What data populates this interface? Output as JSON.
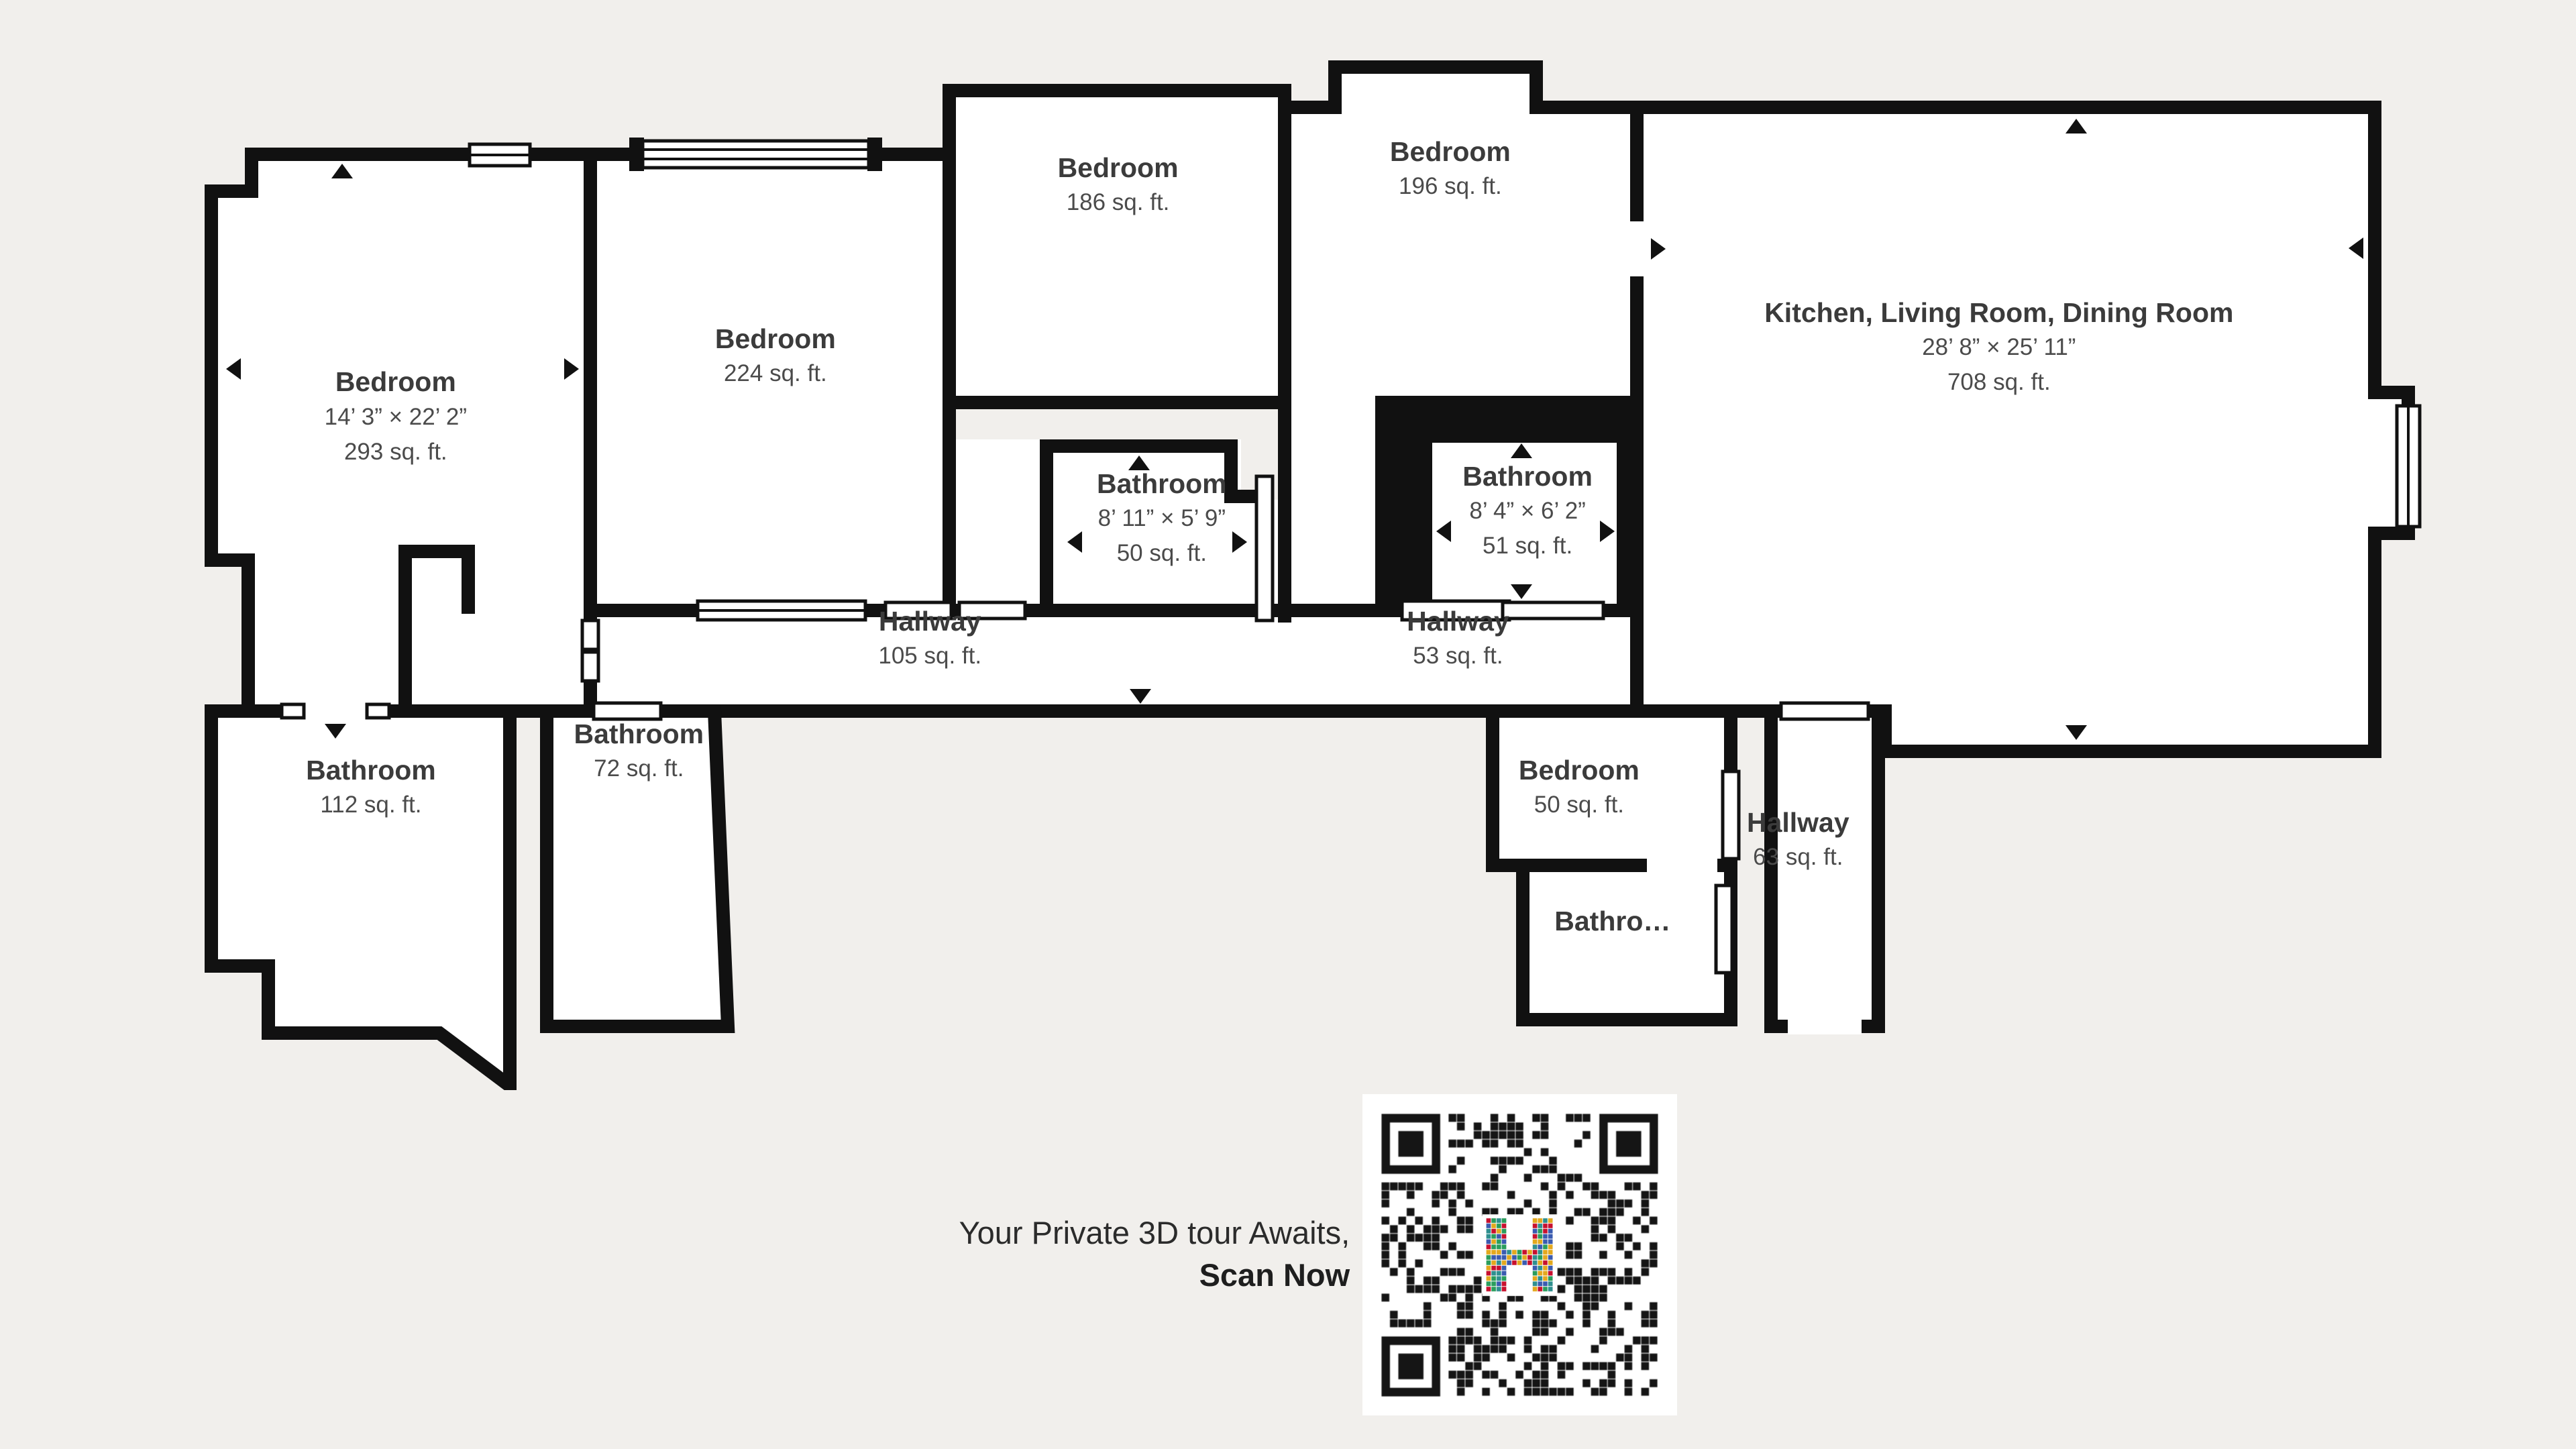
{
  "title": "Floor Plan",
  "colors": {
    "background": "#f1efec",
    "wall": "#111111",
    "room_fill": "#ffffff",
    "label_name": "#3b3b3b",
    "label_sub": "#4b4b4b",
    "qr_logo_palette": [
      "#c8102e",
      "#2f8f8f",
      "#e3a81d",
      "#3a5bb0",
      "#2a9d5c"
    ]
  },
  "rooms": [
    {
      "name": "Bedroom",
      "dims": "14’ 3” × 22’ 2”",
      "area": "293 sq. ft."
    },
    {
      "name": "Bedroom",
      "area": "224 sq. ft."
    },
    {
      "name": "Bedroom",
      "area": "186 sq. ft."
    },
    {
      "name": "Bedroom",
      "area": "196 sq. ft."
    },
    {
      "name": "Kitchen, Living Room, Dining Room",
      "dims": "28’ 8” × 25’ 11”",
      "area": "708 sq. ft."
    },
    {
      "name": "Bathroom",
      "dims": "8’ 11” × 5’ 9”",
      "area": "50 sq. ft."
    },
    {
      "name": "Bathroom",
      "dims": "8’ 4” × 6’ 2”",
      "area": "51 sq. ft."
    },
    {
      "name": "Hallway",
      "area": "105 sq. ft."
    },
    {
      "name": "Hallway",
      "area": "53 sq. ft."
    },
    {
      "name": "Bathroom",
      "area": "112 sq. ft."
    },
    {
      "name": "Bathroom",
      "area": "72 sq. ft."
    },
    {
      "name": "Bedroom",
      "area": "50 sq. ft."
    },
    {
      "name": "Hallway",
      "area": "63 sq. ft."
    },
    {
      "name": "Bathro…"
    }
  ],
  "tour": {
    "line1": "Your Private 3D tour Awaits,",
    "line2": "Scan Now"
  },
  "icons": {
    "qr_logo": "colorful-mosaic-h-logo",
    "door_arrow": "door-arrow",
    "window": "window-symbol"
  }
}
